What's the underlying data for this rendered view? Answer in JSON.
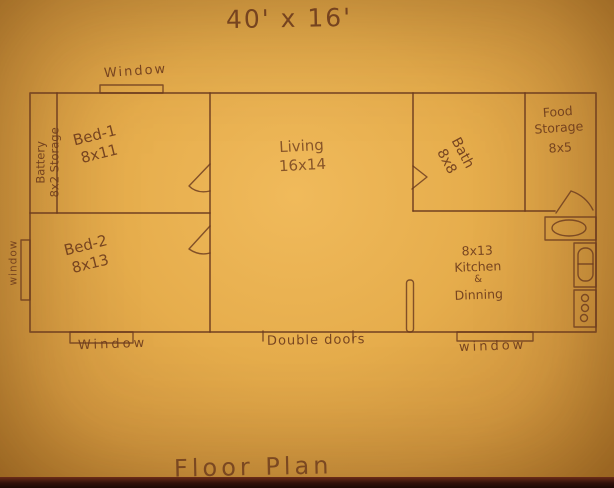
{
  "page": {
    "title": "40' x 16'",
    "caption": "Floor Plan"
  },
  "colors": {
    "paper": "#e2a946",
    "ink": "#6b3a1e"
  },
  "rooms": {
    "battery_storage": {
      "line1": "Battery",
      "line2": "8x2 Storage"
    },
    "bed1": {
      "name": "Bed-1",
      "size": "8x11"
    },
    "bed2": {
      "name": "Bed-2",
      "size": "8x13"
    },
    "living": {
      "name": "Living",
      "size": "16x14"
    },
    "bath": {
      "name": "Bath",
      "size": "8x8"
    },
    "food_storage": {
      "line1": "Food",
      "line2": "Storage",
      "size": "8x5"
    },
    "kitchen": {
      "size": "8x13",
      "line1": "Kitchen",
      "line2": "&",
      "line3": "Dinning"
    }
  },
  "openings": {
    "window_top": "Window",
    "window_left": "window",
    "window_bottom_left": "Window",
    "double_doors": "Double doors",
    "window_bottom_right": "window"
  }
}
